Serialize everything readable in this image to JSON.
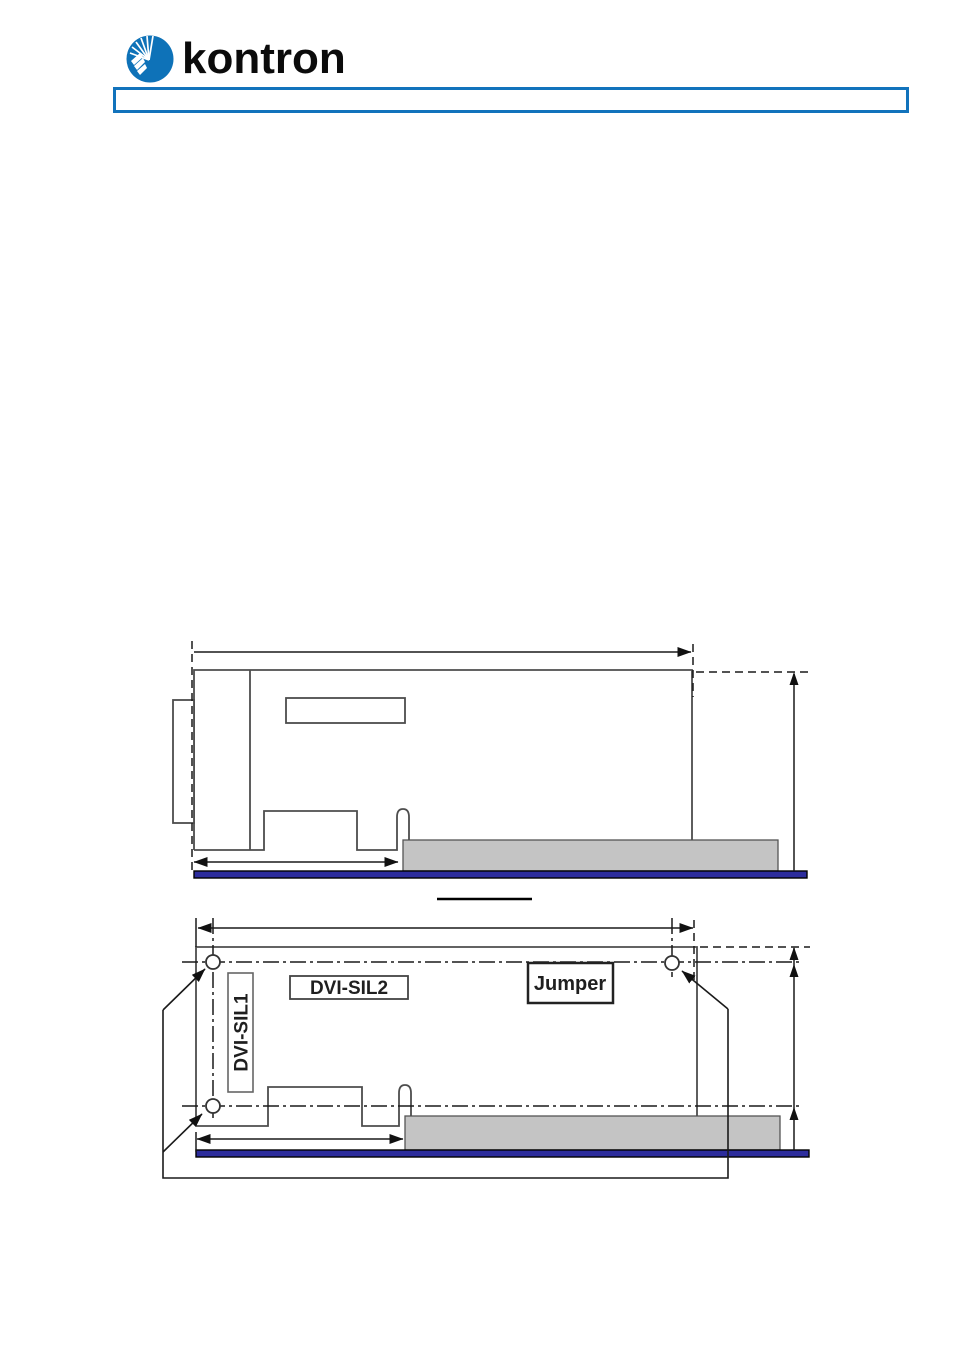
{
  "header": {
    "logo_text": "kontron",
    "title_bar_text": ""
  },
  "figure_side_view": {
    "caption_text": ""
  },
  "figure_top_view": {
    "labels": {
      "dvi_sil1": "DVI-SIL1",
      "dvi_sil2": "DVI-SIL2",
      "jumper": "Jumper"
    }
  },
  "colors": {
    "logo_blue": "#0e72b8",
    "title_bar_border_blue": "#1273bc",
    "drawing_outline_gray": "#4d4d4d",
    "dimension_line_black": "#1a1a1a",
    "component_gray_fill": "#c4c4c4",
    "pcb_navy": "#2c2c9c"
  }
}
